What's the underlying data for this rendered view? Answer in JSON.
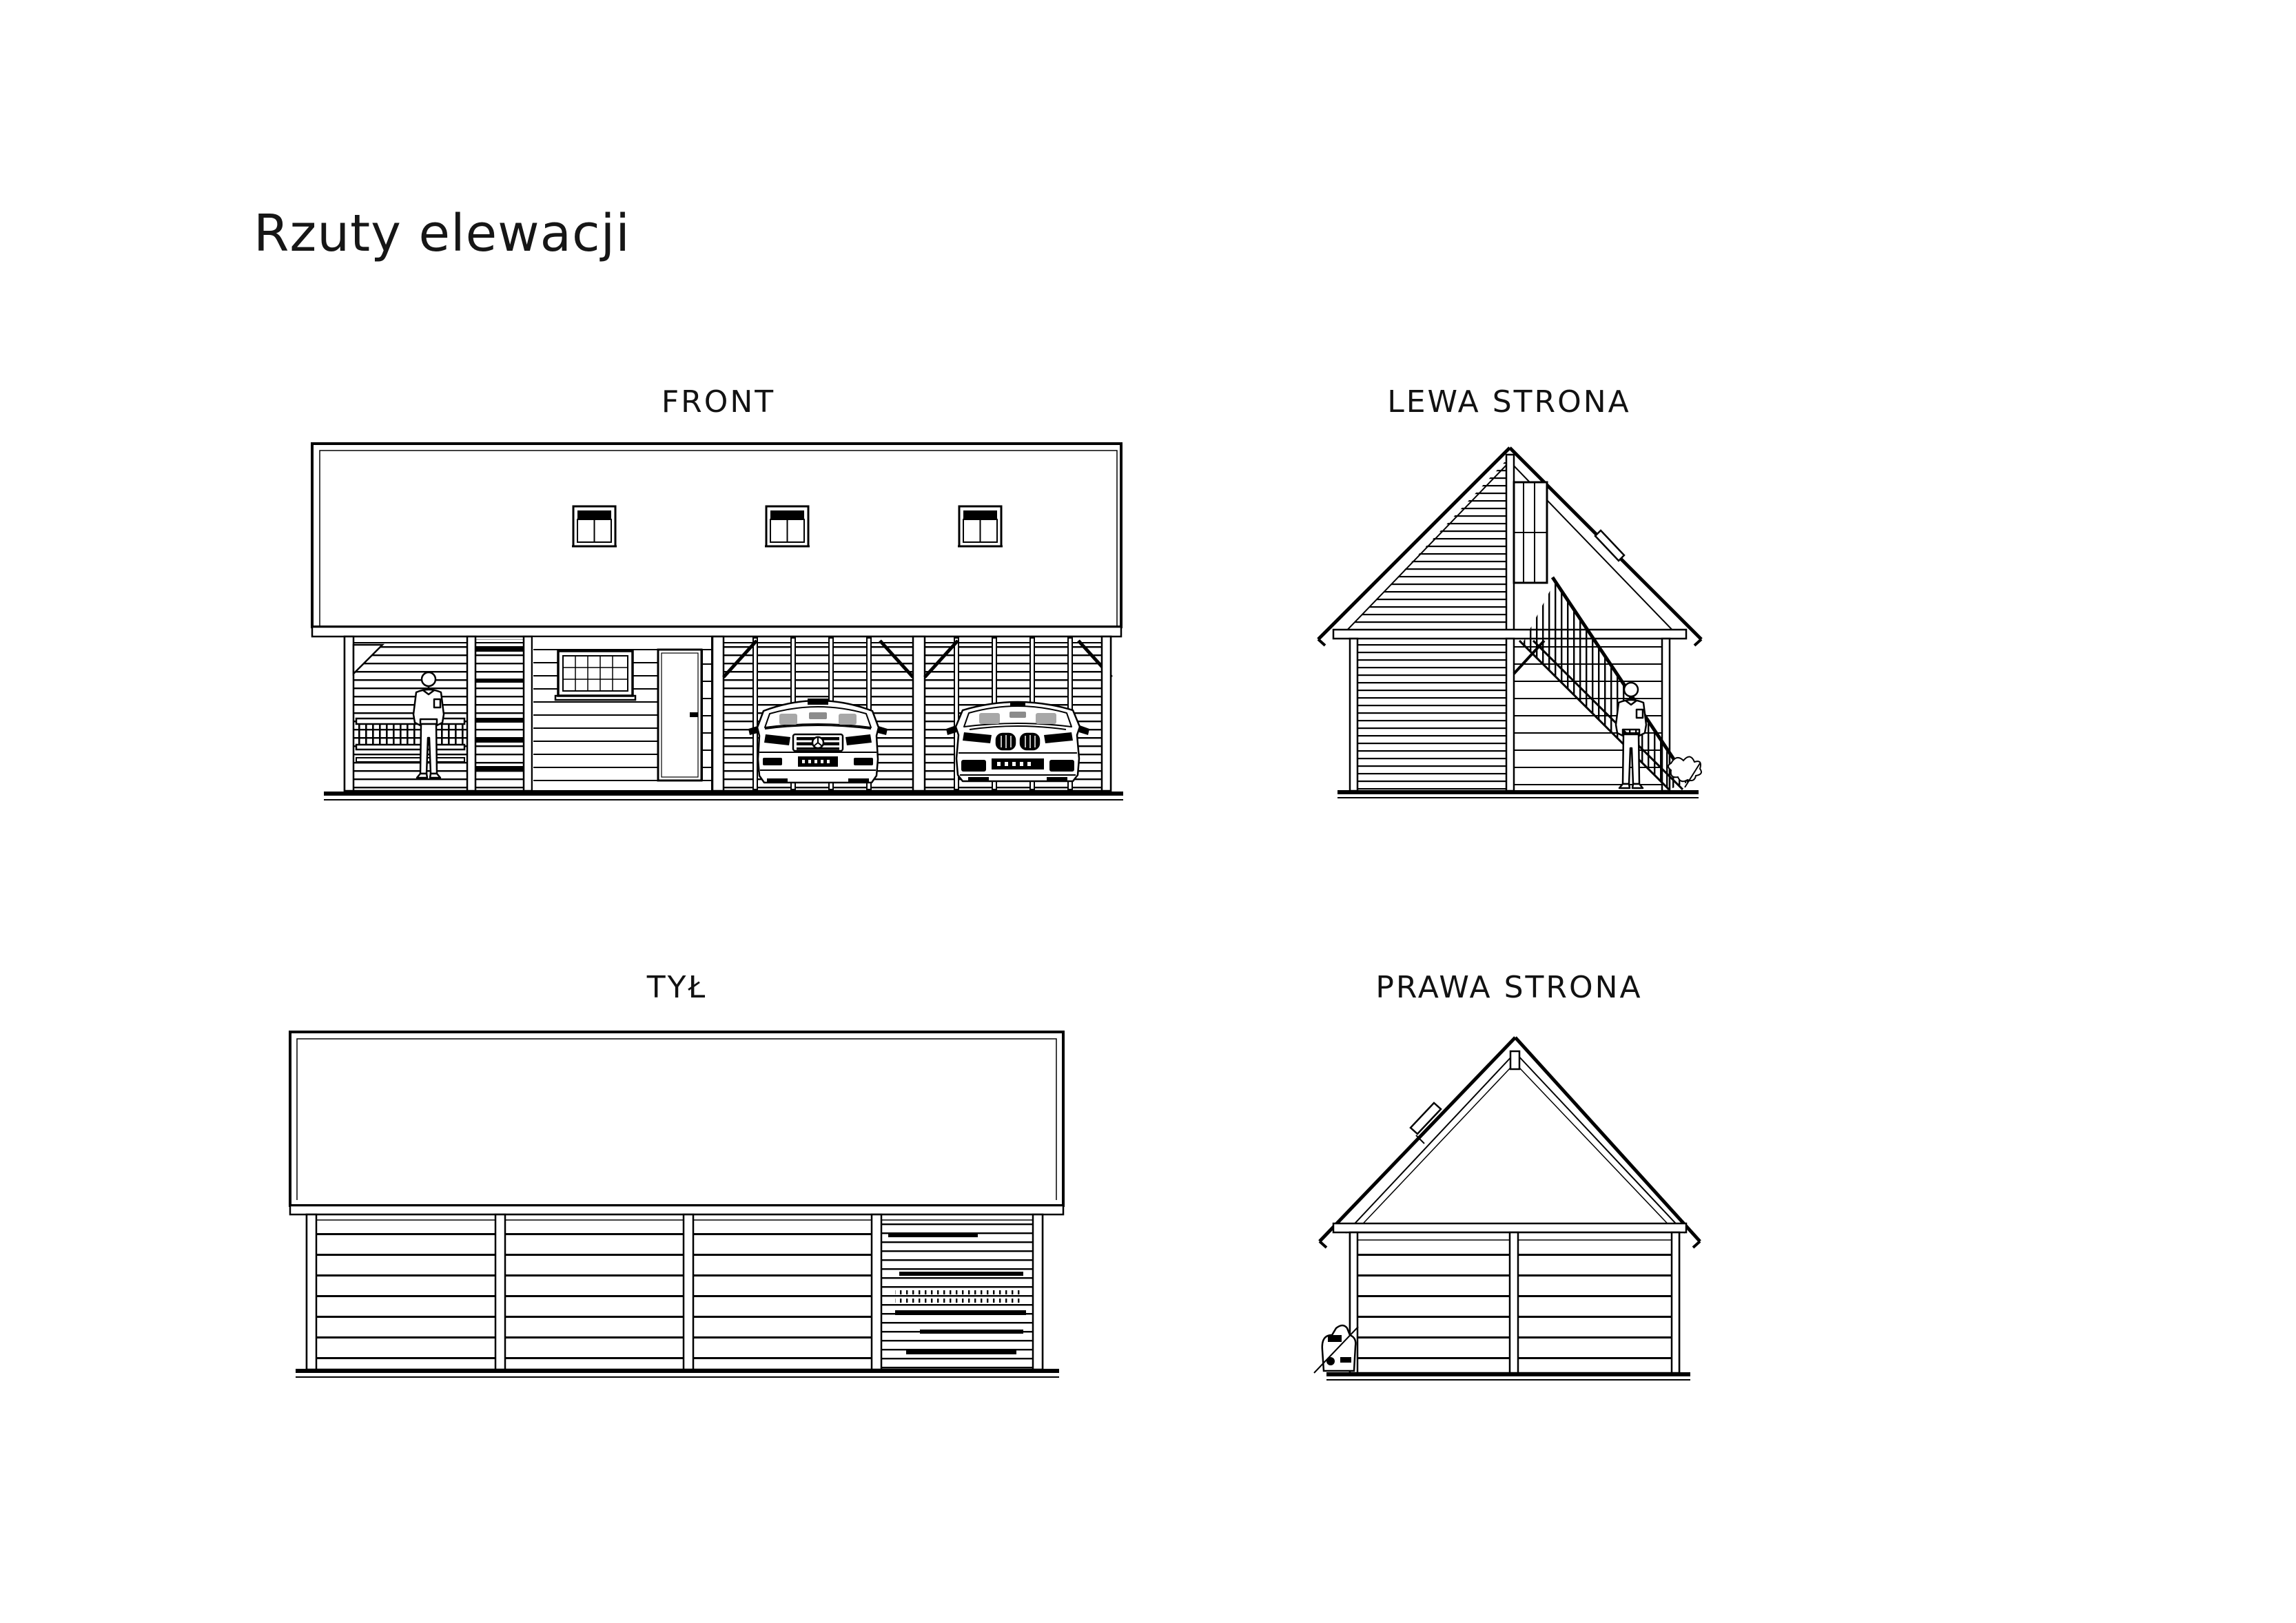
{
  "page": {
    "title": "Rzuty elewacji",
    "background": "#ffffff",
    "line_color": "#000000"
  },
  "views": [
    {
      "id": "front",
      "label": "FRONT"
    },
    {
      "id": "lewa-strona",
      "label": "LEWA STRONA"
    },
    {
      "id": "tyl",
      "label": "TYŁ"
    },
    {
      "id": "prawa-strona",
      "label": "PRAWA STRONA"
    }
  ]
}
